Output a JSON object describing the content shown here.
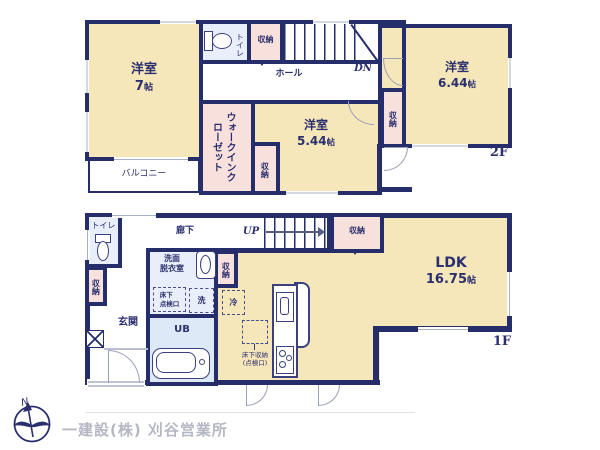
{
  "palette": {
    "wall_navy": "#262d6b",
    "room_cream": "#f6e7ba",
    "closet_pink": "#f8e1dc",
    "wet_area_blue": "#e9effa",
    "label_navy": "#2b2f6e",
    "company_gray": "#b5b7c3"
  },
  "floor2": {
    "floor_label": "2F",
    "room_7": {
      "name": "洋室",
      "size": "7",
      "unit": "帖"
    },
    "toilet": "トイレ",
    "closet_top": "収納",
    "stairs_dn": "DN",
    "hall": "ホール",
    "wic": "ウォークインクローゼット",
    "closet_mid": "収納",
    "room_544": {
      "name": "洋室",
      "size": "5.44",
      "unit": "帖"
    },
    "closet_right": "収納",
    "room_644": {
      "name": "洋室",
      "size": "6.44",
      "unit": "帖"
    },
    "balcony": "バルコニー"
  },
  "floor1": {
    "floor_label": "1F",
    "toilet": "トイレ",
    "corridor": "廊下",
    "stairs_up": "UP",
    "closet_stairs": "収納",
    "closet_entry": "収納",
    "genkan": "玄関",
    "washroom_line1": "洗面",
    "washroom_line2": "脱衣室",
    "hatch_line1": "床下",
    "hatch_line2": "点検口",
    "washer": "洗",
    "fridge": "冷",
    "closet_wash": "収納",
    "ub": "UB",
    "ldk": {
      "name": "LDK",
      "size": "16.75",
      "unit": "帖"
    },
    "underfloor_line1": "床下収納",
    "underfloor_line2": "(点検口)"
  },
  "footer": {
    "north": "N",
    "company": "一建設(株) 刈谷営業所"
  }
}
